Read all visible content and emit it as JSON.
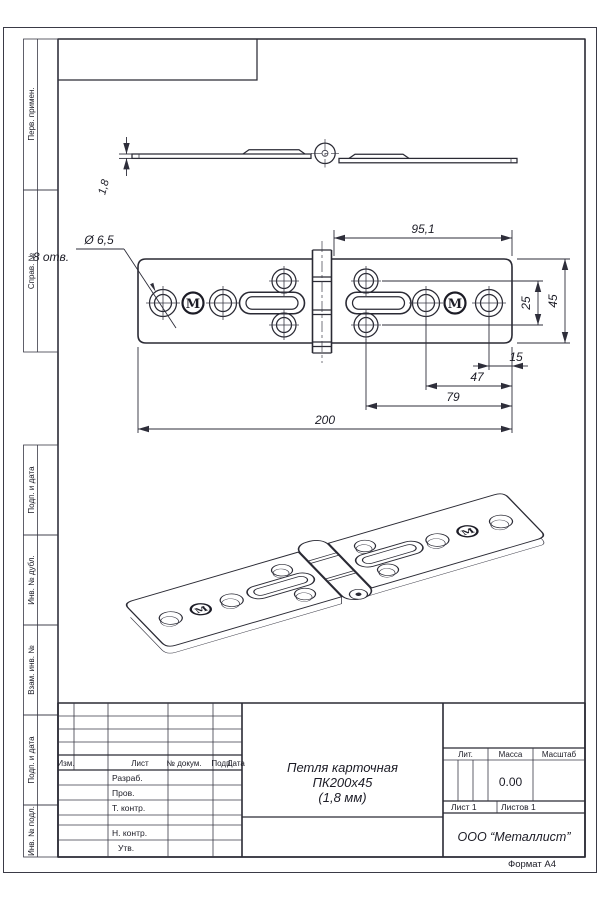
{
  "sheet": {
    "format_note": "Формат А4"
  },
  "margin": {
    "labels": [
      "Перв. примен.",
      "Справ. №",
      "Подп. и дата",
      "Инв. № дубл.",
      "Взам. инв. №",
      "Подп. и дата",
      "Инв. № подл."
    ]
  },
  "callouts": {
    "hole_diameter": "Ø 6,5",
    "hole_count": "8 отв.",
    "thickness": "1,8"
  },
  "dimensions": {
    "d95": "95,1",
    "d25": "25",
    "d45": "45",
    "d15": "15",
    "d47": "47",
    "d79": "79",
    "d200": "200"
  },
  "logo": {
    "mark": "M"
  },
  "title_block": {
    "rev_header": {
      "izm": "Изм.",
      "list": "Лист",
      "doc": "№ докум.",
      "podp": "Подп.",
      "data": "Дата"
    },
    "roles": {
      "razrab": "Разраб.",
      "prov": "Пров.",
      "tkontr": "Т. контр.",
      "nkontr": "Н. контр.",
      "utv": "Утв."
    },
    "name_line1": "Петля карточная",
    "name_line2": "ПК200х45",
    "name_line3": "(1,8 мм)",
    "lit_label": "Лит.",
    "mass_label": "Масса",
    "scale_label": "Масштаб",
    "mass_value": "0.00",
    "sheet_label": "Лист 1",
    "sheets_label": "Листов 1",
    "company": "ООО “Металлист”"
  }
}
